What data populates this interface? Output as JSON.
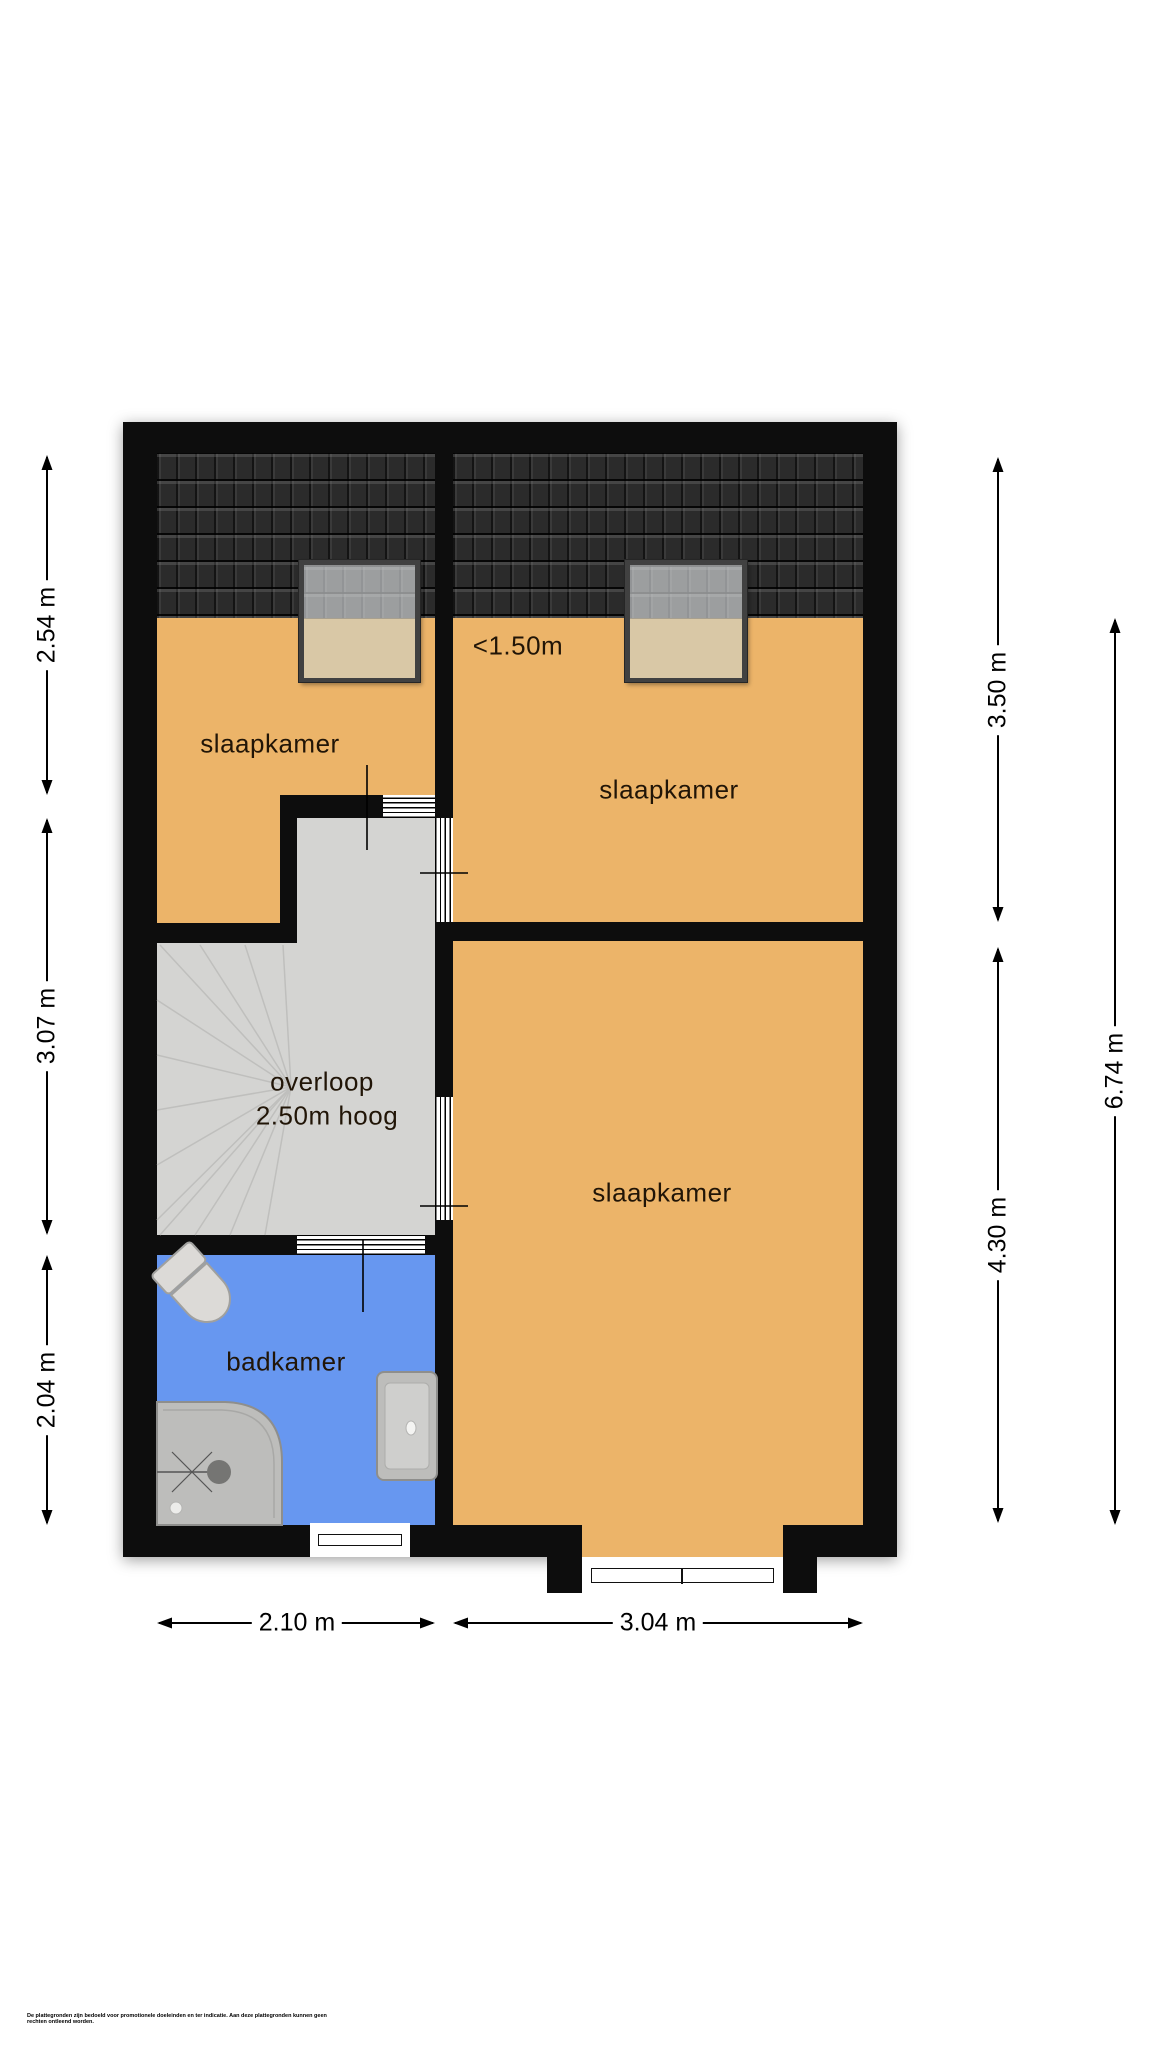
{
  "plan": {
    "rooms": {
      "bedroom1": {
        "label": "slaapkamer"
      },
      "bedroom2": {
        "label": "slaapkamer"
      },
      "bedroom3": {
        "label": "slaapkamer"
      },
      "landing": {
        "label": "overloop",
        "sublabel": "2.50m hoog"
      },
      "bathroom": {
        "label": "badkamer"
      }
    },
    "roof_note": {
      "label": "<1.50m"
    },
    "dimensions": {
      "left": [
        {
          "label": "2.54 m"
        },
        {
          "label": "3.07 m"
        },
        {
          "label": "2.04 m"
        }
      ],
      "right": [
        {
          "label": "3.50 m"
        },
        {
          "label": "4.30 m"
        },
        {
          "label": "6.74 m"
        }
      ],
      "bottom": [
        {
          "label": "2.10 m"
        },
        {
          "label": "3.04 m"
        }
      ]
    },
    "disclaimer": "De plattegronden zijn bedoeld voor promotionele doeleinden en ter indicatie. Aan deze plattegronden kunnen geen rechten ontleend worden.",
    "colors": {
      "floor": "#ecb469",
      "bathroom": "#6797f0",
      "landing": "#d4d4d2",
      "wall": "#0d0d0d",
      "roof": "#2b2b2b",
      "window_beige": "#d9c8a6",
      "fixture": "#bdbdbb"
    }
  }
}
